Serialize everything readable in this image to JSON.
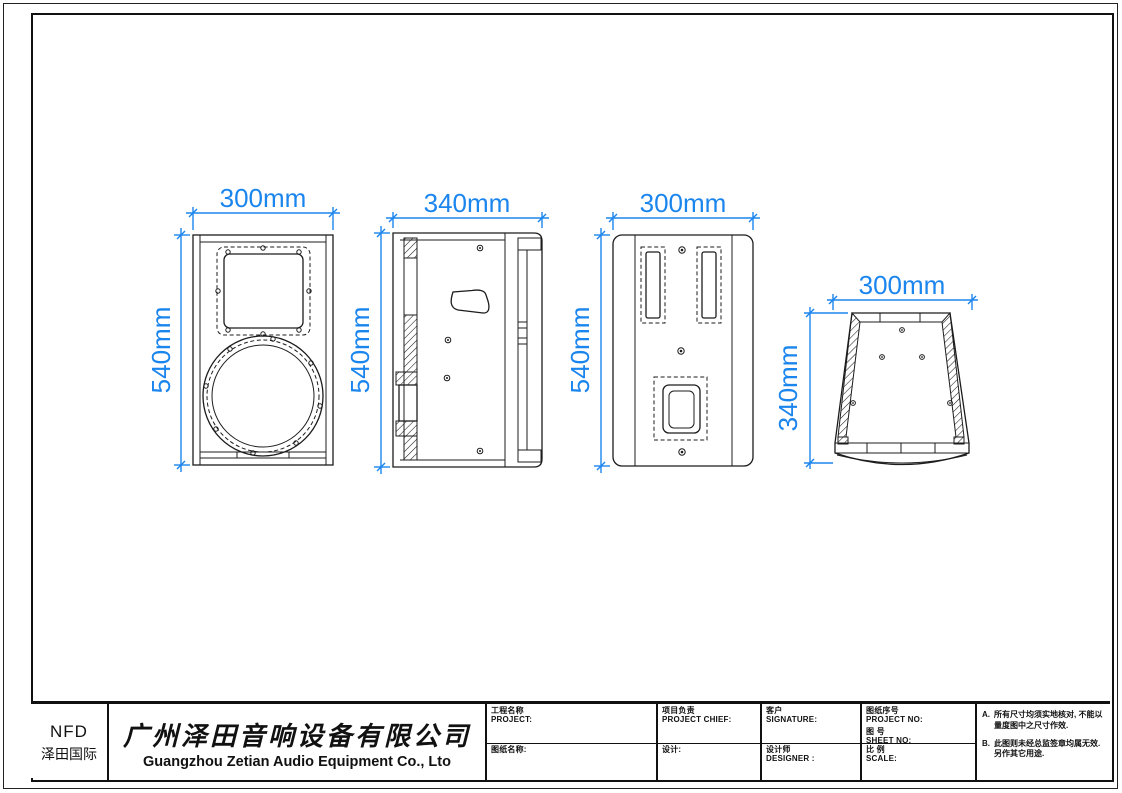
{
  "colors": {
    "dimension_blue": "#1b85ee",
    "line_black": "#1c1c1c"
  },
  "logo": {
    "brand": "NFD",
    "brand_cn": "泽田国际"
  },
  "company": {
    "name_cn": "广州泽田音响设备有限公司",
    "name_en": "Guangzhou Zetian Audio Equipment Co., Lto"
  },
  "title_block": {
    "project_cn": "工程名称",
    "project_en": "PROJECT:",
    "drawing_name": "图纸名称:",
    "chief_cn": "项目负责",
    "chief_en": "PROJECT CHIEF:",
    "design": "设计:",
    "client_cn": "客户",
    "client_en": "SIGNATURE:",
    "designer_cn": "设计师",
    "designer_en": "DESIGNER :",
    "drawing_no_cn": "图纸序号",
    "drawing_no_en": "PROJECT NO:",
    "sheet_no_cn": "图 号",
    "sheet_no_en": "SHEET NO:",
    "scale_cn": "比 例",
    "scale_en": "SCALE:",
    "notes": [
      {
        "tag": "A.",
        "text": "所有尺寸均须实地核对, 不能以量度图中之尺寸作效."
      },
      {
        "tag": "B.",
        "text": "此图则未经总监签章均属无效. 另作其它用途."
      }
    ]
  },
  "views": [
    {
      "id": "front-view",
      "width_label": "300mm",
      "height_label": "540mm"
    },
    {
      "id": "side-view",
      "width_label": "340mm",
      "height_label": "540mm"
    },
    {
      "id": "back-view",
      "width_label": "300mm",
      "height_label": "540mm"
    },
    {
      "id": "bottom-view",
      "width_label": "300mm",
      "height_label": "340mm"
    }
  ]
}
